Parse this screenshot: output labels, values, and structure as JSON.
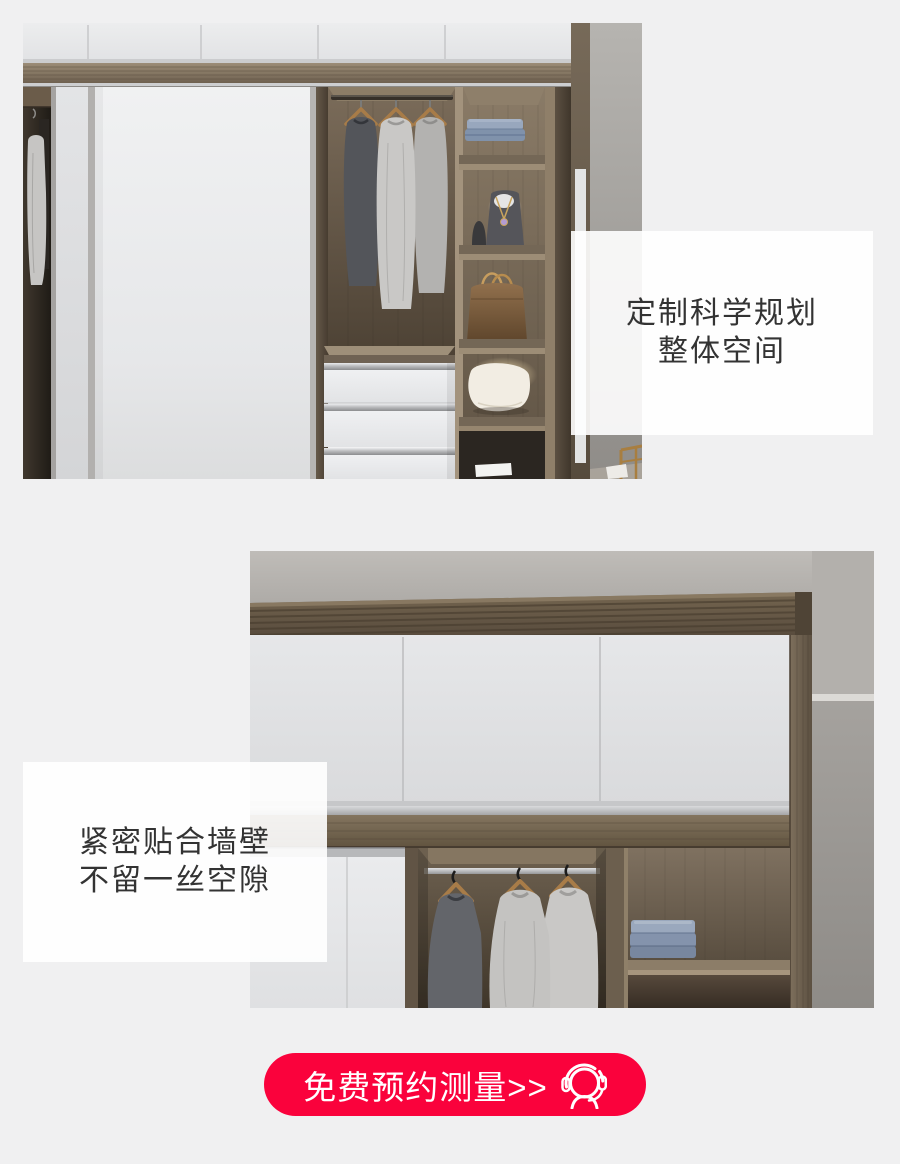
{
  "page": {
    "background_color": "#f0f0f1"
  },
  "captions": {
    "top": {
      "line1": "定制科学规划",
      "line2": "整体空间"
    },
    "bottom": {
      "line1": "紧密贴合墙壁",
      "line2": "不留一丝空隙"
    }
  },
  "cta": {
    "label": "免费预约测量>>",
    "icon": "customer-service-headset-icon",
    "background_color": "#fa023c",
    "text_color": "#ffffff"
  },
  "colors": {
    "caption_text": "#333333",
    "caption_box_bg": "rgba(255,255,255,0.9)"
  }
}
